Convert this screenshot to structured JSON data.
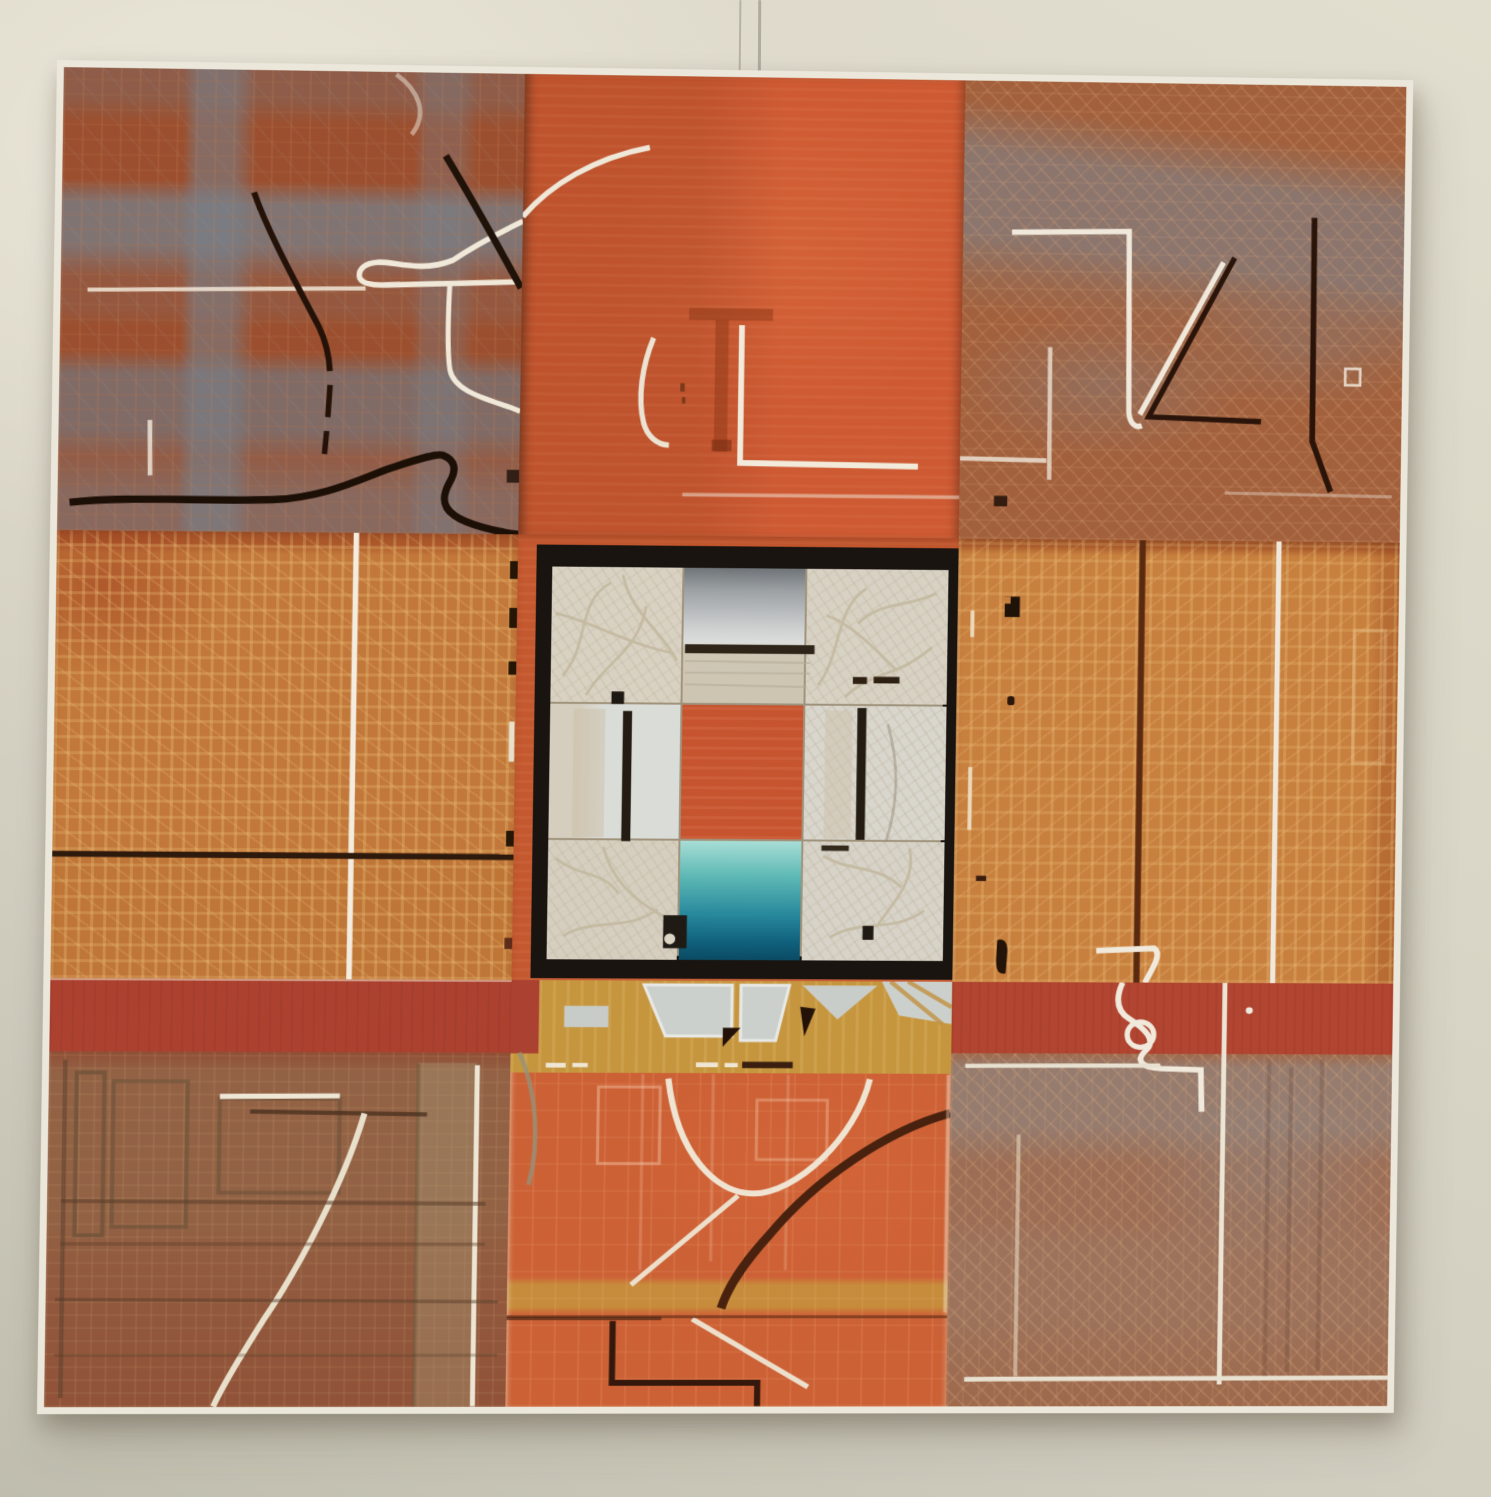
{
  "scene": {
    "description": "Photograph of a large abstract mixed-media painting hanging on a plain gallery wall, lit from upper left, with a faint hanging wire above the top edge",
    "wall_color": "#d9d5c6",
    "wall_highlight": "#e6e2d4",
    "wall_shadow": "#c0bdae",
    "wire_color": "#968f7e"
  },
  "painting": {
    "composition": "3x3 grid of textured abstract panels in rust, orange and amber with a black-framed inner square at the center",
    "canvas_edge_color": "#ebe7da",
    "frame_black": "#191410",
    "palette": {
      "rust": "#9c4f2e",
      "orange": "#ce5a33",
      "amber": "#c2783a",
      "red_band_left": "#ad4130",
      "red_band_right": "#b24531",
      "gold_band": "#c6963f",
      "blue_gray": "#7e8a94",
      "cream": "#d9d2c3",
      "silver": "#c3c6c7",
      "teal_top": "#a8ddd6",
      "teal_bottom": "#0b4a63",
      "line_white": "#f0e8d8",
      "line_black": "#241208"
    },
    "panels": [
      {
        "id": "top-left",
        "base_color": "#9c4f2e",
        "description": "rust panel with horizontal and vertical blue-gray bands, black arcing lines, a white looped line and a black wavy line at bottom"
      },
      {
        "id": "top-center",
        "base_color": "#ce5a33",
        "description": "flat orange panel with white arc at upper left, muted dark T shape, white J-curve and white right-angle lines"
      },
      {
        "id": "top-right",
        "base_color": "#a2603c",
        "description": "rust crosshatch panel with blue-gray haze, white 7-shaped line, white diagonal, dark angular lines"
      },
      {
        "id": "middle-left",
        "base_color": "#c2783a",
        "description": "amber panel with golden crosshatching, central white vertical line, black horizontal line, black dashes along right edge"
      },
      {
        "id": "center",
        "base_color": "#c4582f",
        "description": "orange surround holding the black-framed inner square composition"
      },
      {
        "id": "middle-right",
        "base_color": "#c8803e",
        "description": "amber panel with dark brown vertical line, white vertical line, small black marks near left edge, white squiggle start at bottom"
      },
      {
        "id": "bottom-left",
        "base_color": "#8f4a32",
        "description": "dark red panel with red band on top, sage-gray rectangular frames, sweeping white arc and white vertical line at right"
      },
      {
        "id": "bottom-center",
        "base_color": "#cd6136",
        "description": "orange panel with gold top strip holding silver fragments, white U-curve, thick dark arc, gold band, white diagonals and dark angular line"
      },
      {
        "id": "bottom-right",
        "base_color": "#a2613e",
        "description": "rust crosshatch panel with red band and white squiggle on top, blue-gray haze, white vertical and horizontal lines"
      }
    ],
    "center_square": {
      "border_color": "#191410",
      "cells": [
        {
          "id": "top-left",
          "color": "#d9d2c3",
          "desc": "etched cream with small black square at bottom"
        },
        {
          "id": "top-center",
          "color": "#c3c6c7",
          "desc": "silver gradient, black horizontal bar, beige below"
        },
        {
          "id": "top-right",
          "color": "#d8d2c4",
          "desc": "etched cream with two black dashes"
        },
        {
          "id": "middle-left",
          "color": "#dadcd8",
          "desc": "pale bluish white with black vertical bar"
        },
        {
          "id": "middle-center",
          "color": "#c5542f",
          "desc": "solid orange-red"
        },
        {
          "id": "middle-right",
          "color": "#d9d6cd",
          "desc": "pale cream with black vertical bar and faint arc"
        },
        {
          "id": "bottom-left",
          "color": "#d6cfc0",
          "desc": "etched cream with black notch shape and white dot"
        },
        {
          "id": "bottom-center",
          "color": "#2a8fa0",
          "desc": "teal gradient light to deep"
        },
        {
          "id": "bottom-right",
          "color": "#d7d3c8",
          "desc": "etched cream with small black block"
        }
      ]
    }
  }
}
